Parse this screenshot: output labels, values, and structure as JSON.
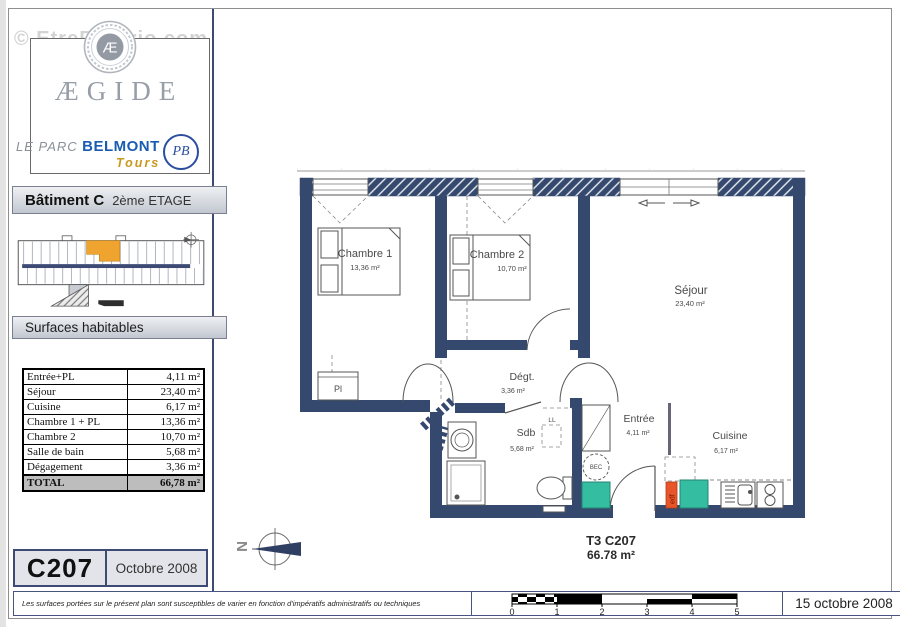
{
  "watermark": "© EtreProprio.com",
  "brand": {
    "name": "ÆGIDE",
    "medallion_letter": "Æ",
    "residence": {
      "prefix": "LE PARC",
      "name": "BELMONT",
      "city": "Tours",
      "monogram": "PB"
    }
  },
  "header": {
    "building": "Bâtiment C",
    "floor": "2ème ETAGE"
  },
  "surfaces": {
    "title": "Surfaces habitables",
    "rows": [
      {
        "label": "Entrée+PL",
        "value": "4,11 m²"
      },
      {
        "label": "Séjour",
        "value": "23,40 m²"
      },
      {
        "label": "Cuisine",
        "value": "6,17 m²"
      },
      {
        "label": "Chambre 1 + PL",
        "value": "13,36 m²"
      },
      {
        "label": "Chambre 2",
        "value": "10,70 m²"
      },
      {
        "label": "Salle de bain",
        "value": "5,68 m²"
      },
      {
        "label": "Dégagement",
        "value": "3,36 m²"
      }
    ],
    "total": {
      "label": "TOTAL",
      "value": "66,78 m²"
    }
  },
  "unit": {
    "id": "C207",
    "date": "Octobre 2008"
  },
  "plan": {
    "rooms": {
      "chambre1": {
        "name": "Chambre 1",
        "area": "13,36 m²"
      },
      "chambre2": {
        "name": "Chambre 2",
        "area": "10,70 m²"
      },
      "sejour": {
        "name": "Séjour",
        "area": "23,40 m²"
      },
      "degagement": {
        "name": "Dégt.",
        "area": "3,36 m²"
      },
      "sdb": {
        "name": "Sdb",
        "area": "5,68 m²"
      },
      "entree": {
        "name": "Entrée",
        "area": "4,11 m²"
      },
      "cuisine": {
        "name": "Cuisine",
        "area": "6,17 m²"
      }
    },
    "annotations": {
      "placard": "Pl",
      "lave_linge": "LL",
      "bec": "BEC",
      "edf": "edf"
    },
    "summary": {
      "type_unit": "T3 C207",
      "area": "66.78 m²"
    },
    "compass_letter": "N"
  },
  "footer": {
    "disclaimer": "Les surfaces portées sur le présent plan sont susceptibles de varier en fonction d'impératifs administratifs ou techniques",
    "scale_ticks": [
      "0",
      "1",
      "2",
      "3",
      "4",
      "5"
    ],
    "date": "15 octobre 2008"
  },
  "colors": {
    "wall_navy": "#35496e",
    "unit_highlight_orange": "#f0a430",
    "shaft_teal": "#35bda1",
    "edf_orange": "#e8552b",
    "belmont_blue": "#1a5cb0",
    "tours_gold": "#c8991e"
  }
}
